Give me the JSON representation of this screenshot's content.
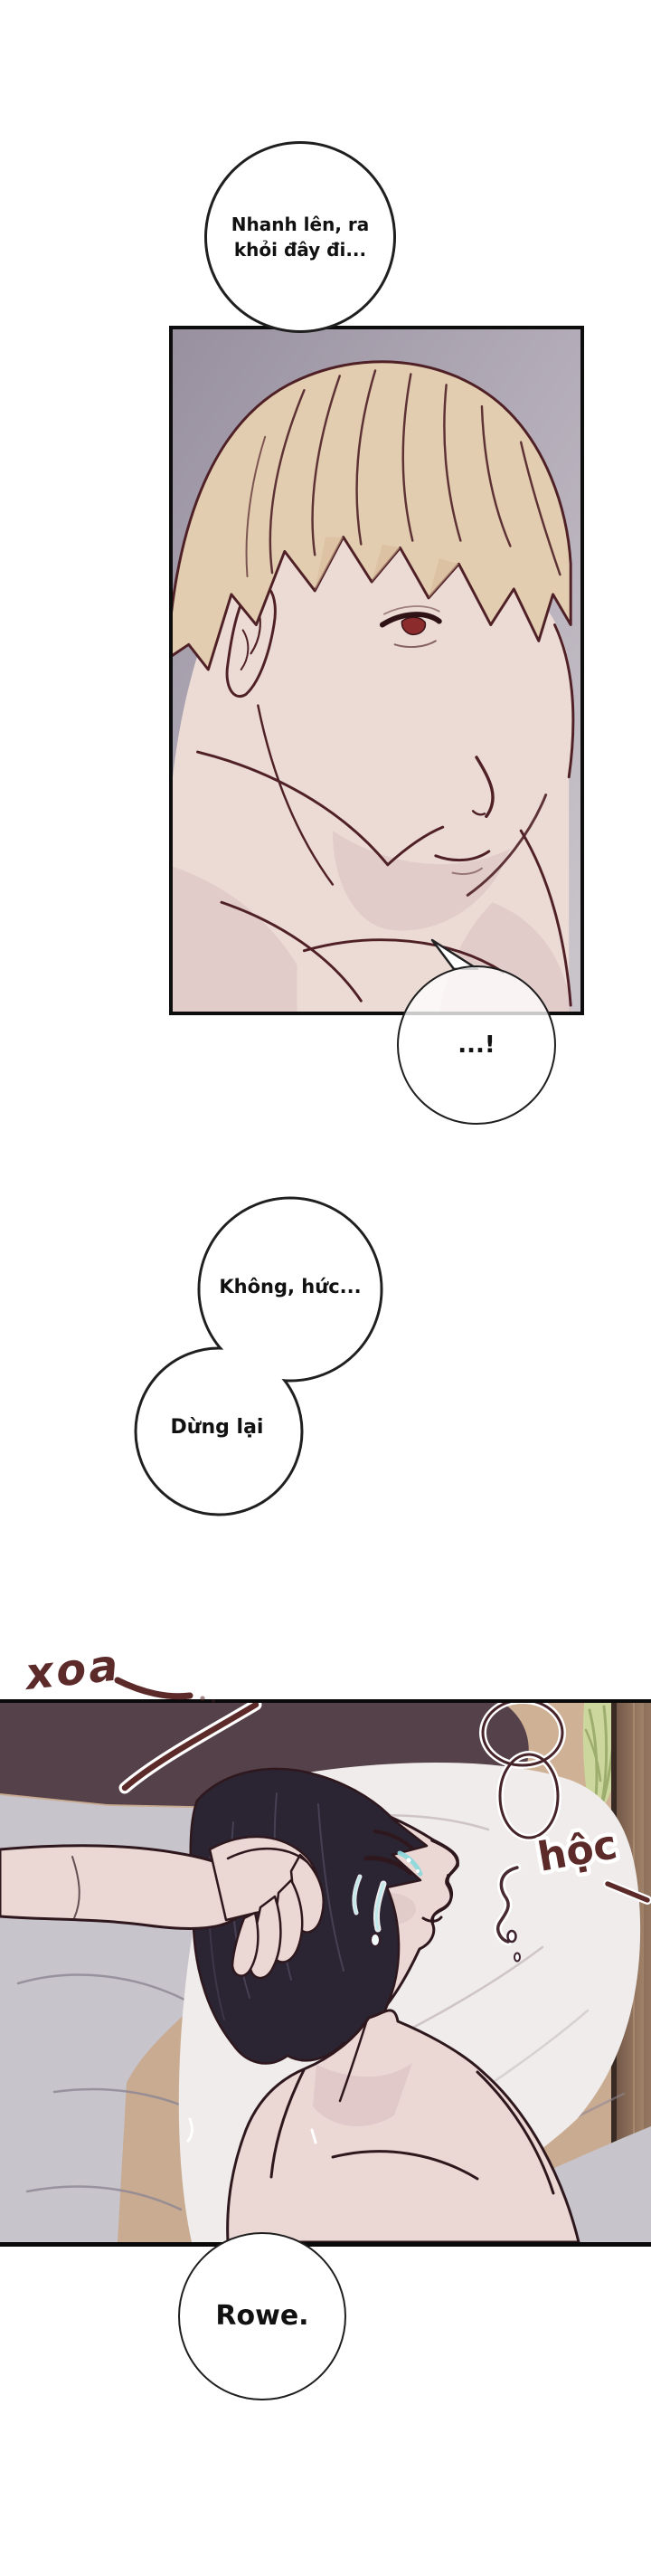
{
  "bubbles": {
    "top": {
      "text": "Nhanh lên, ra\nkhỏi đây đi..."
    },
    "exclaim": {
      "text": "...!"
    },
    "no": {
      "text": "Không, hức..."
    },
    "stop": {
      "text": "Dừng lại"
    },
    "name": {
      "text": "Rowe."
    }
  },
  "sfx": {
    "stroke": "xoa",
    "gasp": "hộc"
  },
  "colors": {
    "line": "#4f2127",
    "line2": "#2e181e",
    "sfx": "#5d2a2a",
    "bubble-stroke": "#1f1f1f",
    "panel1-bg-dark": "#98909f",
    "panel1-bg-mid": "#b3acb8",
    "panel1-bg-light": "#c9c3ca",
    "hair-blonde": "#e3cdb1",
    "hair-shadow": "#d8ba99",
    "skin": "#ecdad5",
    "skin-shadow": "#d9c1c1",
    "eye-red": "#8c2b2b",
    "dark-band": "#554149",
    "wall": "#c9ab91",
    "plant": "#ccd79d",
    "plant-line": "#9dad6e",
    "wardrobe-dark": "#6b5143",
    "wardrobe-light": "#aa8c72",
    "wardrobe-edge": "#3a2a24",
    "sheet-gray": "#c7c4cb",
    "sheet-line": "#8d8694",
    "pillow-white": "#efeceb",
    "pillow-line": "#cfc5c9",
    "hair-dark": "#2b2432",
    "hair-strand": "#4a4258",
    "skin2": "#ebd8d4",
    "skin2-shadow": "#d9c0c0",
    "tear-teal": "#8ed8da"
  }
}
